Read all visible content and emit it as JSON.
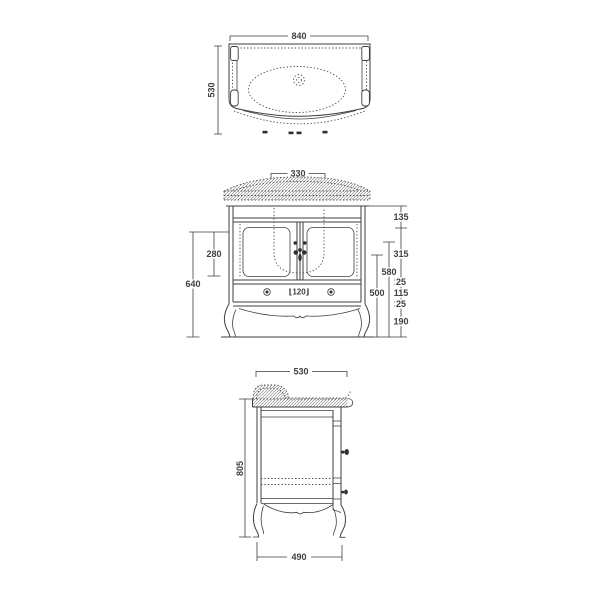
{
  "colors": {
    "background": "#ffffff",
    "line": "#3f3f3f",
    "text": "#3f3f3f"
  },
  "plan_view": {
    "width": "840",
    "depth": "530"
  },
  "front_view": {
    "basin_width": "330",
    "door_opening_height": "280",
    "carcass_height": "640",
    "mid_height": "580",
    "inner_height": "500",
    "drawer_label": "⌊120⌋",
    "segments": [
      "135",
      "315",
      "25",
      "115",
      "25",
      "190"
    ]
  },
  "side_view": {
    "depth": "530",
    "height": "805",
    "base_depth": "490"
  }
}
